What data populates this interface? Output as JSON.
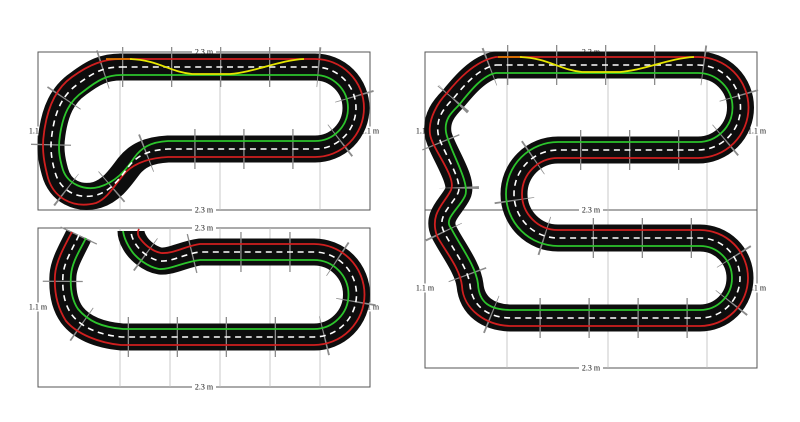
{
  "colors": {
    "background": "#ffffff",
    "track": "#0d0d0d",
    "outer_lane": "#cf1f1f",
    "inner_lane": "#2cc42c",
    "center_line": "#ffffff",
    "racing_line": "#e6e600",
    "racing_line_alt": "#dd7700",
    "joint": "#8c8c8c",
    "grid": "#bbbbbb",
    "border": "#555555",
    "label": "#111111"
  },
  "tracks": [
    {
      "name": "closed-loop-with-hairpin",
      "panel": "top-left"
    },
    {
      "name": "open-oval-unfinished-ends",
      "panel": "bottom-left"
    },
    {
      "name": "serpentine-double-height",
      "panel": "right"
    }
  ],
  "panels": [
    {
      "name": "top-left",
      "labels": {
        "top": "2.3 m",
        "bottom": "2.3 m",
        "left": "1.1 m",
        "right": "1.1 m"
      }
    },
    {
      "name": "bottom-left",
      "labels": {
        "top": "2.3 m",
        "bottom": "2.3 m",
        "left": "1.1 m",
        "right": "1.1 m"
      }
    },
    {
      "name": "right-upper",
      "labels": {
        "top": "2.3 m",
        "left": "1.1 m",
        "right": "1.1 m"
      }
    },
    {
      "name": "right-lower",
      "labels": {
        "top": "2.3 m",
        "bottom": "2.3 m",
        "left": "1.1 m",
        "right": "1.1 m"
      }
    }
  ]
}
